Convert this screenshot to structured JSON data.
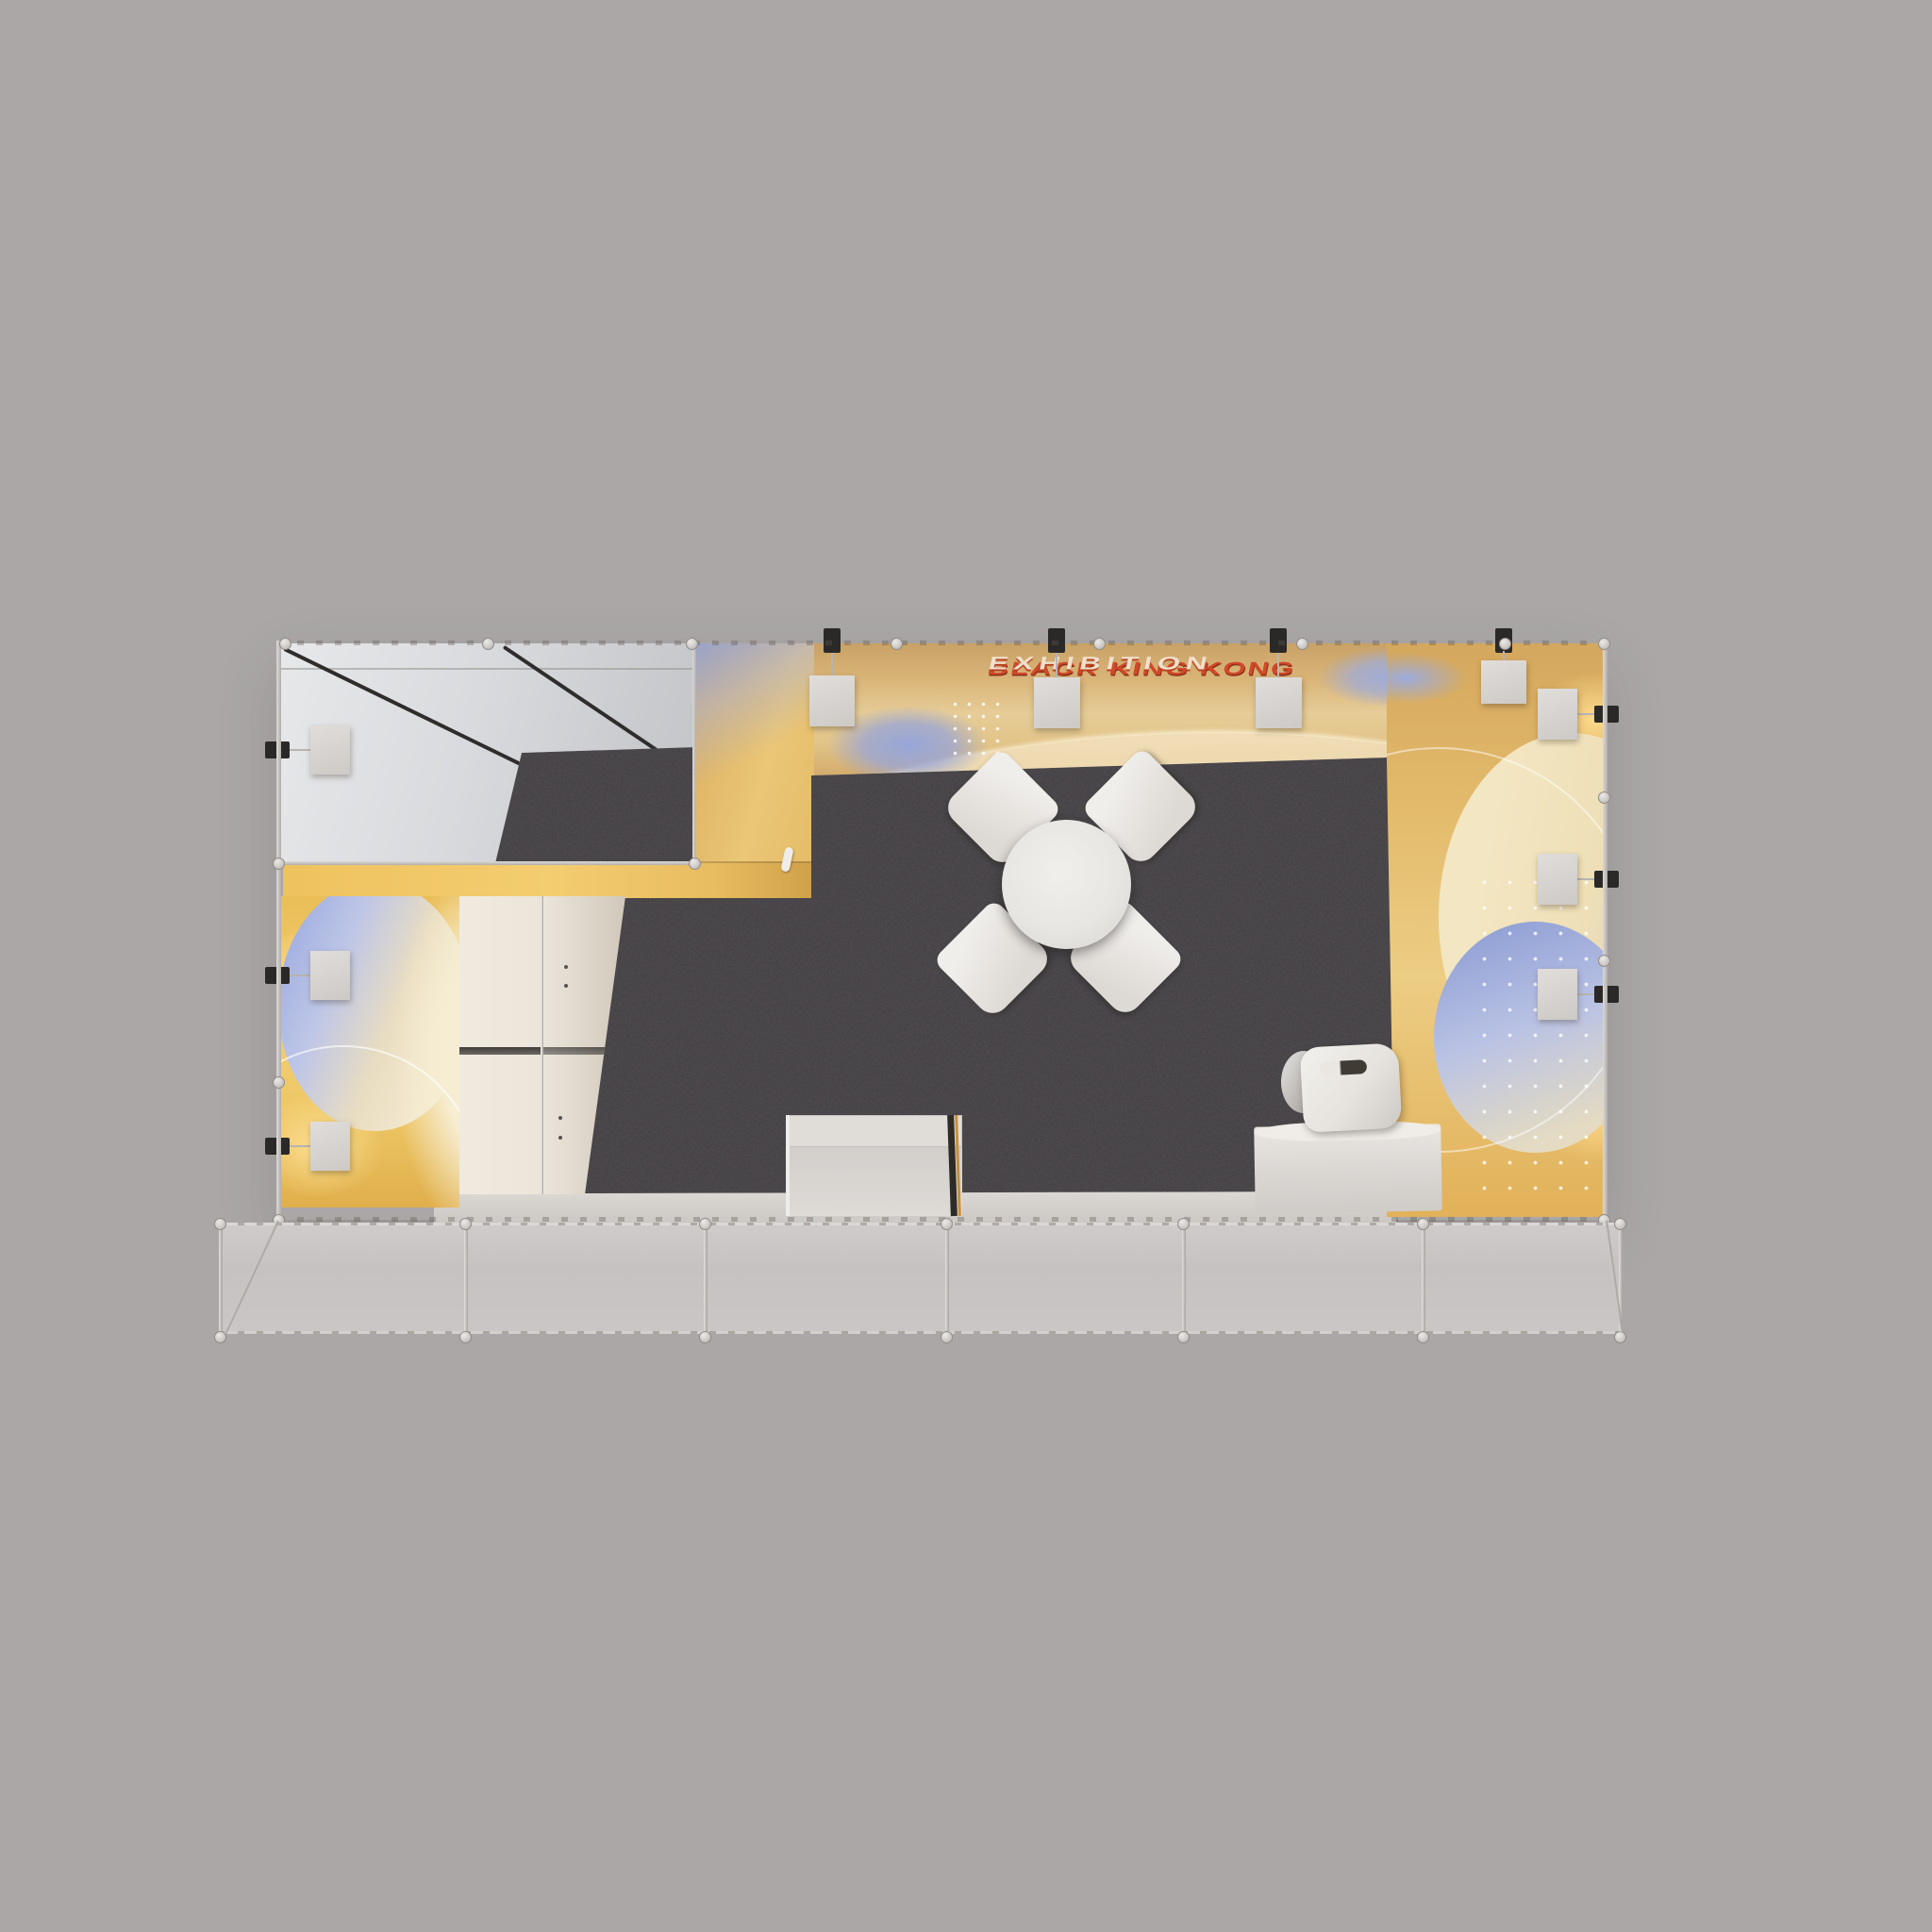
{
  "signage": {
    "line1": "BLACK KING KONG",
    "line2": "EXHIBITION"
  },
  "palette": {
    "background": "#aba7a7",
    "carpet": "#4a474a",
    "wall_yellow": "#eabf63",
    "wall_orange": "#d99a3c",
    "graphic_blue": "#9fade0",
    "graphic_cream": "#f2e9cf",
    "signage_red": "#cf4a28",
    "furniture_white": "#eceae6",
    "frame_silver": "#cfccc9",
    "fascia_gray": "#c6c2c1",
    "room_wall_white": "#dadde0",
    "wall_edge_black": "#2f2d2c"
  }
}
